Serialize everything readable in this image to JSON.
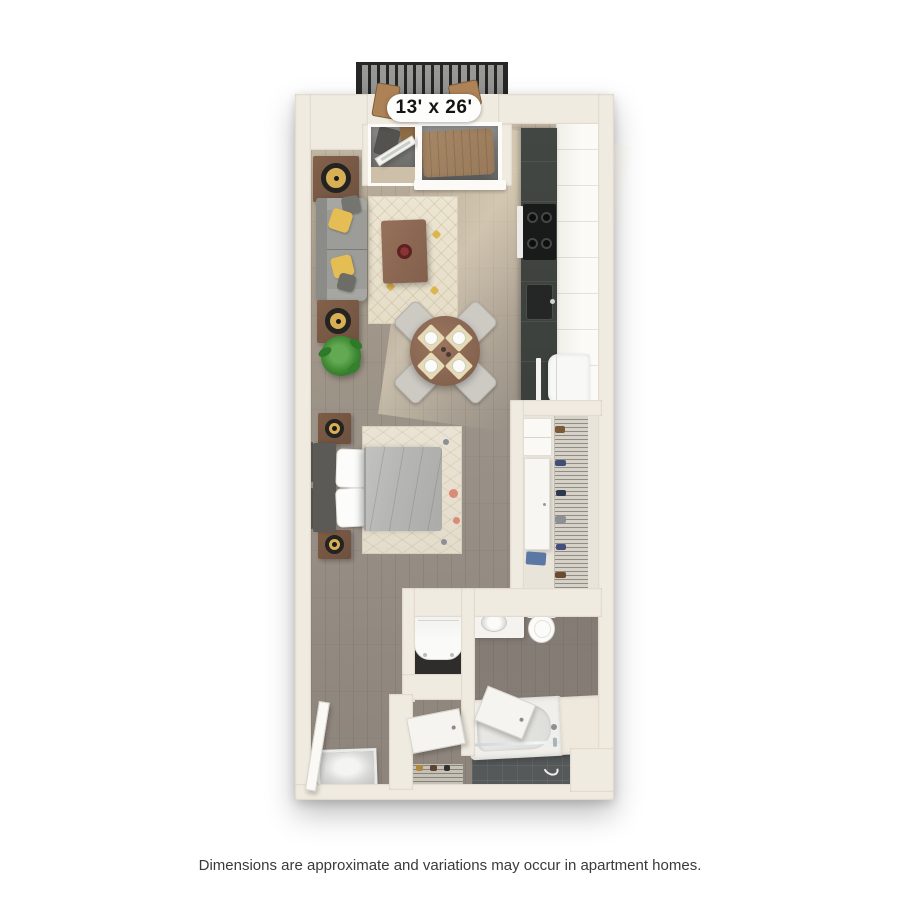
{
  "floorplan": {
    "dimensions_label": "13' x 26'"
  },
  "footer": {
    "disclaimer": "Dimensions are approximate and variations may occur in apartment homes."
  },
  "palette": {
    "background": "#ffffff",
    "wall": "#f0ebe0",
    "floor_wood": "#9a9189",
    "floor_light": "#c7bba9",
    "kitchen_counter": "#40443f",
    "balcony_railing": "#262626",
    "balcony_wood": "#ad8257",
    "sofa_gray": "#9c9c98",
    "pillow_yellow": "#e4bd54",
    "table_wood_brown": "#86644f",
    "bed_duvet_gray": "#b6b6b4",
    "rug_cream": "#ece5d2",
    "plant_green": "#3f8a34",
    "tile_dark": "#55595a",
    "fixture_white": "#f5f4f1",
    "label_text": "#141414",
    "footer_text": "#3a3a3a"
  }
}
